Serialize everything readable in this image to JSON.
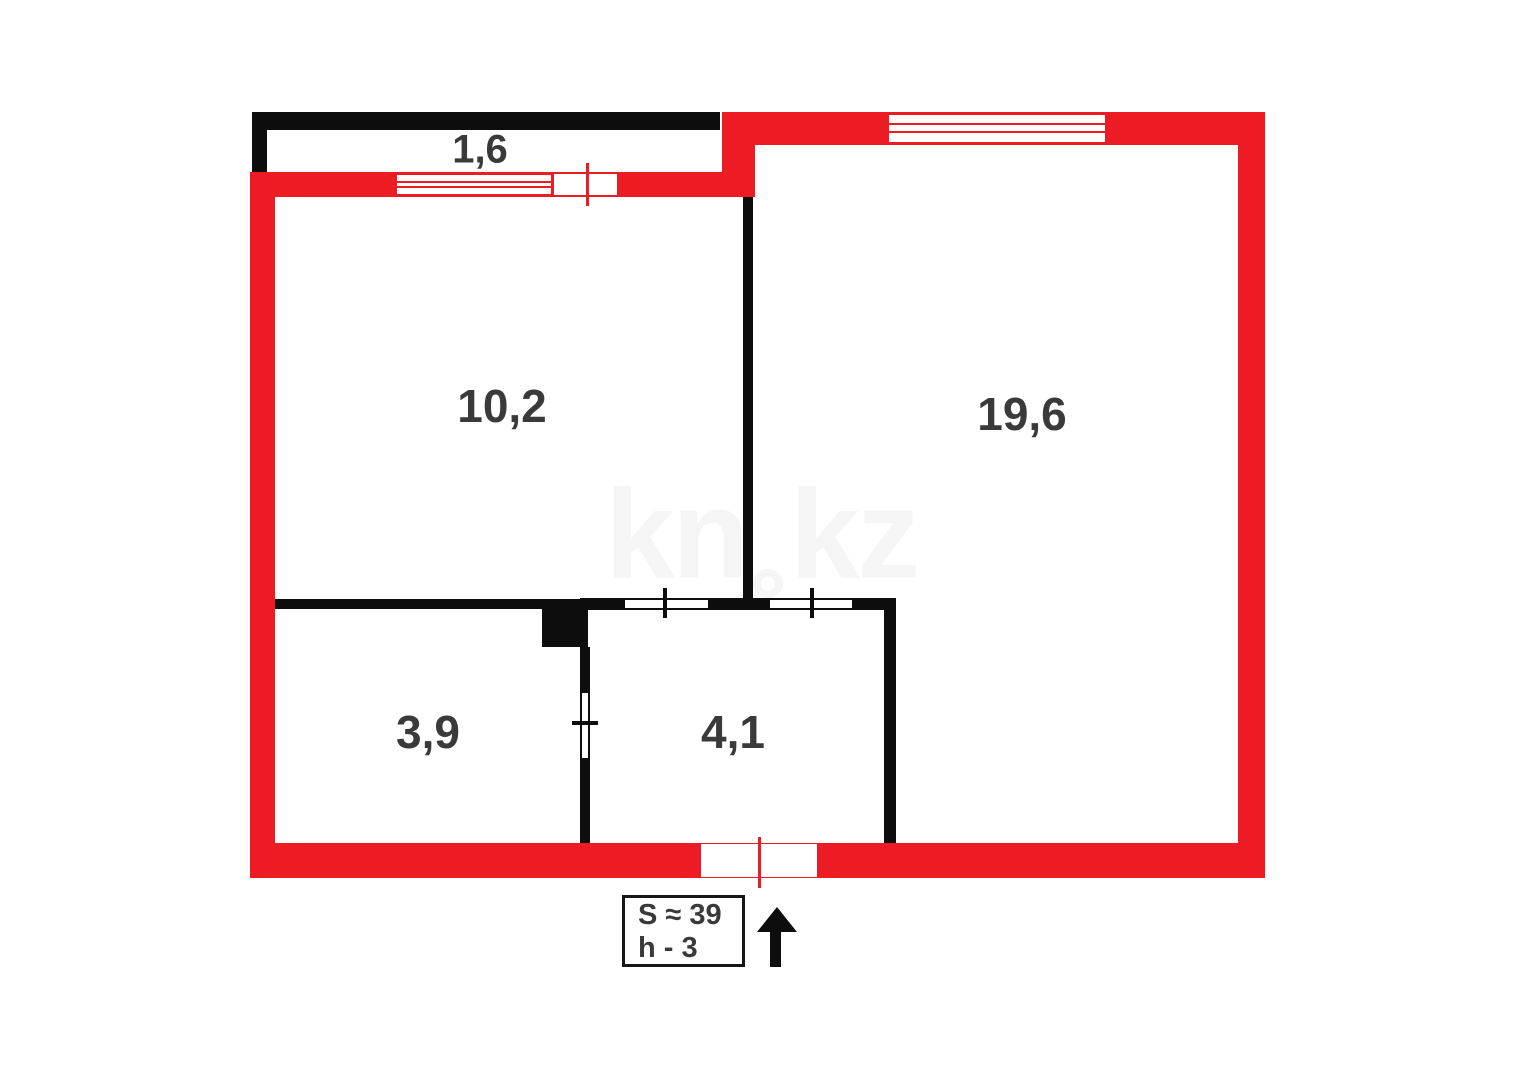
{
  "plan": {
    "watermark": {
      "full": "kn.kz",
      "part1": "kn",
      "part2": "kz"
    },
    "rooms": {
      "balcony": {
        "area": "1,6"
      },
      "room_top_left": {
        "area": "10,2"
      },
      "room_right": {
        "area": "19,6"
      },
      "room_bottom_left": {
        "area": "3,9"
      },
      "hallway": {
        "area": "4,1"
      }
    },
    "info_box": {
      "total_area": "S ≈ 39",
      "ceiling_height": "h - 3"
    },
    "colors": {
      "wall_red": "#ed1c24",
      "wall_black": "#0d0d0d",
      "room_label": "#3a3a3a",
      "watermark": "#f5f5f5",
      "background": "#ffffff"
    }
  }
}
